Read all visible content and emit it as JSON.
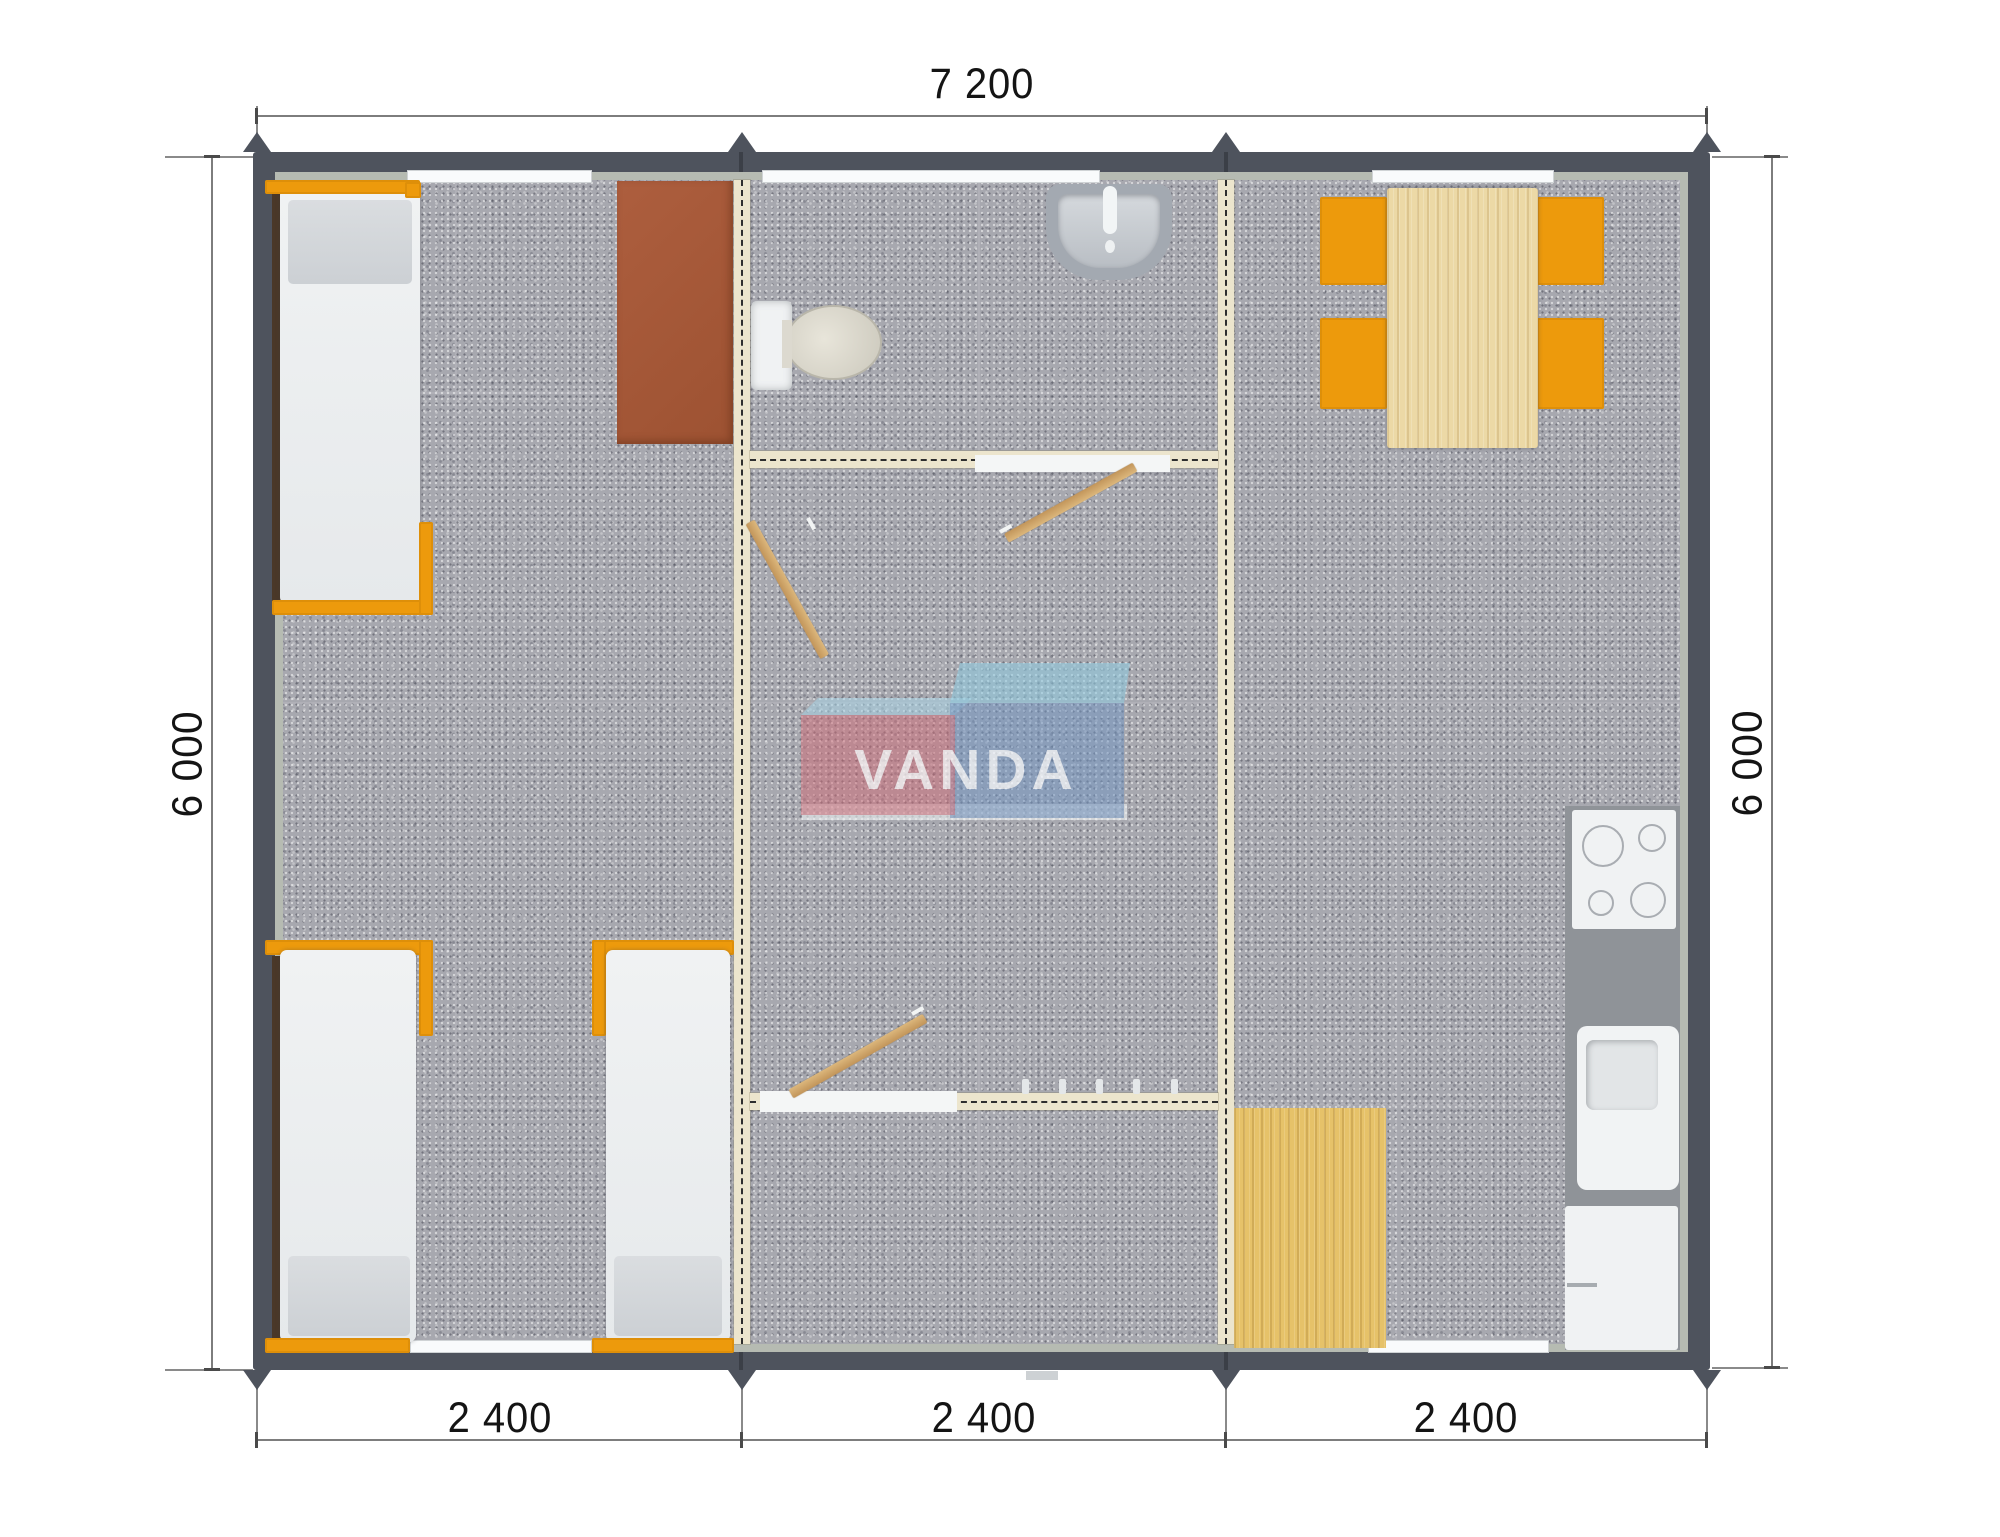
{
  "watermark": {
    "brand": "VANDA",
    "box_left_color": "#d26b76",
    "box_right_color": "#6f94c4",
    "top_face_color": "#a6d2e2"
  },
  "dimensions": {
    "top": {
      "label": "7 200"
    },
    "left": {
      "label": "6 000"
    },
    "right": {
      "label": "6 000"
    },
    "bottom": [
      {
        "label": "2 400"
      },
      {
        "label": "2 400"
      },
      {
        "label": "2 400"
      }
    ]
  },
  "colors": {
    "outer_wall": "#4e535d",
    "partition_wall": "#ece5cd",
    "carpet": "#a7a8af",
    "accent_orange": "#ed9a0c",
    "wood": "#e6c269",
    "brown_table": "#a85a3b",
    "counter": "#8f9398"
  },
  "fixtures": [
    "bed",
    "bed",
    "bed",
    "bed",
    "brown-table",
    "toilet",
    "washbasin",
    "dining-table",
    "chair",
    "chair",
    "chair",
    "chair",
    "cooktop",
    "kitchen-sink",
    "kitchen-cabinet",
    "wood-floor-mat"
  ]
}
